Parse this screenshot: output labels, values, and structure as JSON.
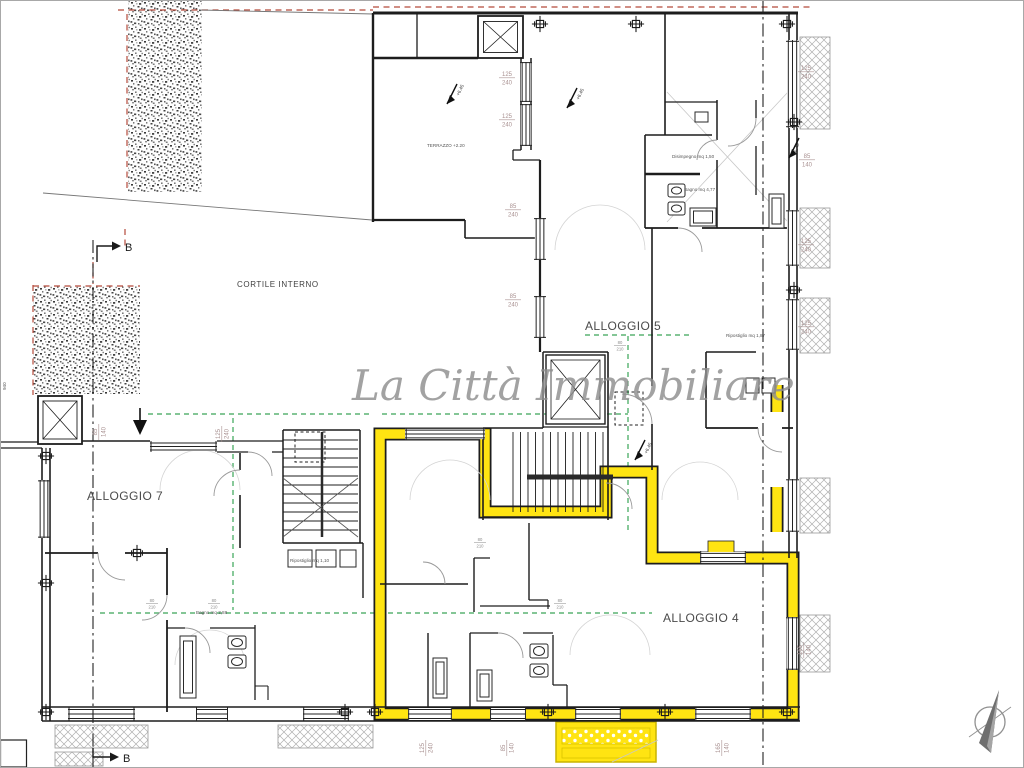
{
  "watermark": {
    "text": "La Città Immobiliare"
  },
  "labels": {
    "cortile_interno": "CORTILE INTERNO",
    "alloggio_5": "ALLOGGIO 5",
    "alloggio_7": "ALLOGGIO 7",
    "alloggio_4": "ALLOGGIO 4",
    "terrazzo": "TERRAZZO +2.20",
    "section_top": "B",
    "section_bottom": "B",
    "edge_note": "940"
  },
  "room_labels": [
    {
      "text": "Disimpegno mq 1,50"
    },
    {
      "text": "Bagno mq 4,77"
    },
    {
      "text": "Ripostiglio mq 1,87"
    },
    {
      "text": "Bagno mq 3,88"
    },
    {
      "text": "Ripostiglio mq 1,10"
    }
  ],
  "level_markers": [
    {
      "text": "+6.45"
    },
    {
      "text": "+6.45"
    },
    {
      "text": "+6.45"
    },
    {
      "text": "+6.45"
    }
  ],
  "dimensions": [
    {
      "w": "125",
      "h": "240"
    },
    {
      "w": "125",
      "h": "240"
    },
    {
      "w": "85",
      "h": "240"
    },
    {
      "w": "85",
      "h": "240"
    },
    {
      "w": "125",
      "h": "240"
    },
    {
      "w": "85",
      "h": "140"
    },
    {
      "w": "125",
      "h": "240"
    },
    {
      "w": "125",
      "h": "240"
    },
    {
      "w": "85",
      "h": "140"
    },
    {
      "w": "125",
      "h": "240"
    },
    {
      "w": "125",
      "h": "240"
    },
    {
      "w": "85",
      "h": "140"
    },
    {
      "w": "165",
      "h": "140"
    },
    {
      "w": "165",
      "h": "140"
    }
  ],
  "door_dimensions": [
    {
      "w": "80",
      "h": "210"
    },
    {
      "w": "80",
      "h": "210"
    },
    {
      "w": "80",
      "h": "210"
    },
    {
      "w": "80",
      "h": "210"
    },
    {
      "w": "80",
      "h": "210"
    }
  ],
  "colors": {
    "highlight_yellow": "#ffe412",
    "wall_black": "#1d1d1d",
    "green_dashed": "#3aa558",
    "red_dashed": "#b54a3b",
    "dimension_text": "#a89090",
    "watermark_gray": "#8e8e8e"
  }
}
